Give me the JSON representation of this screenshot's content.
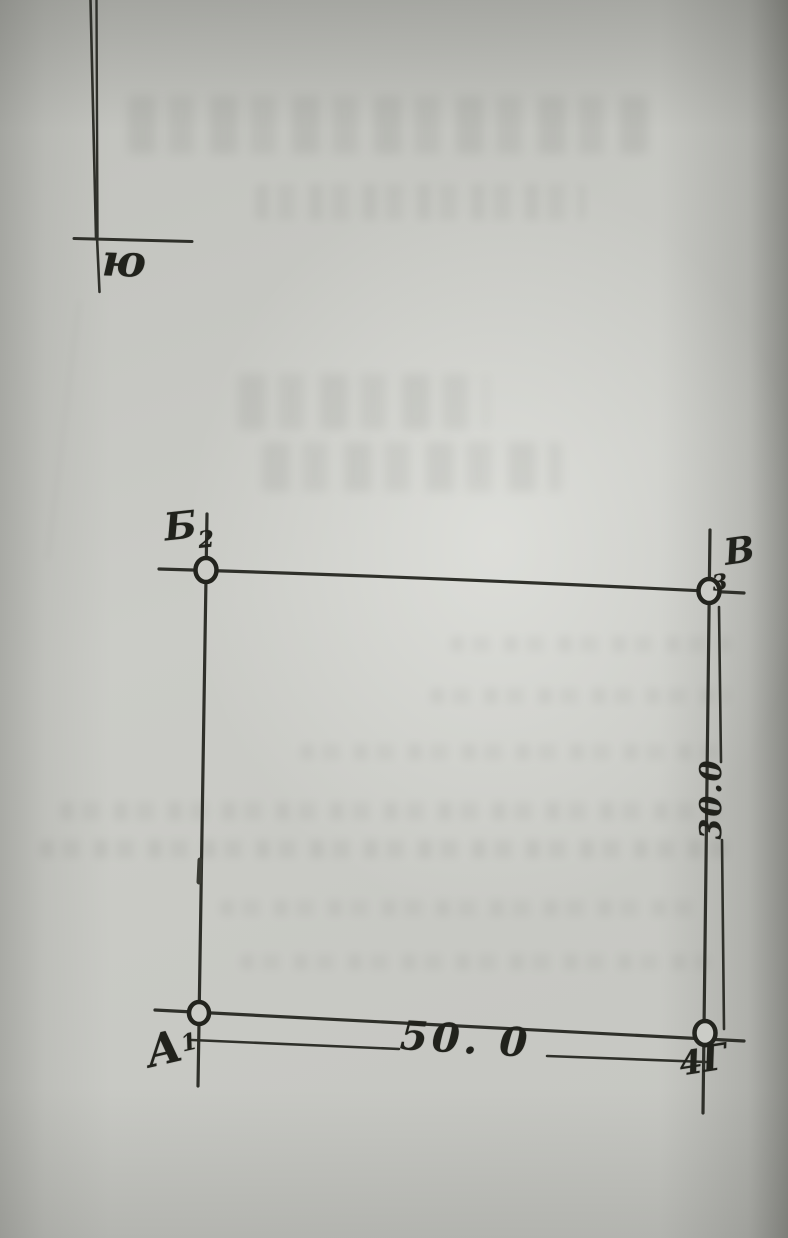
{
  "compass": {
    "south_label": "ю"
  },
  "plot": {
    "corners": {
      "top_left": {
        "letter": "Б",
        "number": "2"
      },
      "top_right": {
        "letter": "В",
        "number": "3"
      },
      "bottom_left": {
        "letter": "А",
        "number": "1"
      },
      "bottom_right": {
        "letter": "Г",
        "number": "4"
      }
    },
    "dimensions": {
      "bottom": "50. 0",
      "right": "30.0"
    }
  },
  "colors": {
    "paper": "#cbccc7",
    "ink": "#2f302a",
    "marker_ink": "#23241e"
  }
}
